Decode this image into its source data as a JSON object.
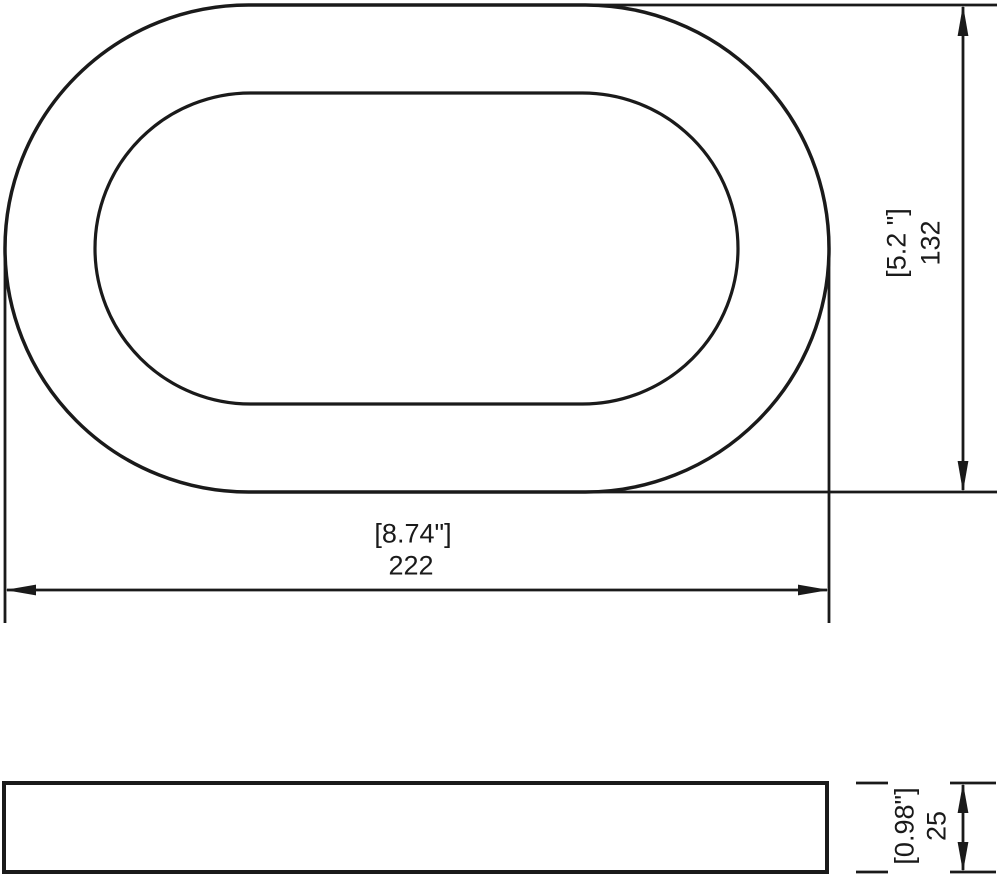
{
  "colors": {
    "line": "#1a1a1a",
    "background": "#ffffff"
  },
  "views": {
    "top": {
      "width_dim": {
        "inches": "[8.74\"]",
        "mm": "222"
      },
      "height_dim": {
        "inches": "[5.2 \"]",
        "mm": "132"
      }
    },
    "side": {
      "thickness_dim": {
        "inches": "[0.98\"]",
        "mm": "25"
      }
    }
  }
}
